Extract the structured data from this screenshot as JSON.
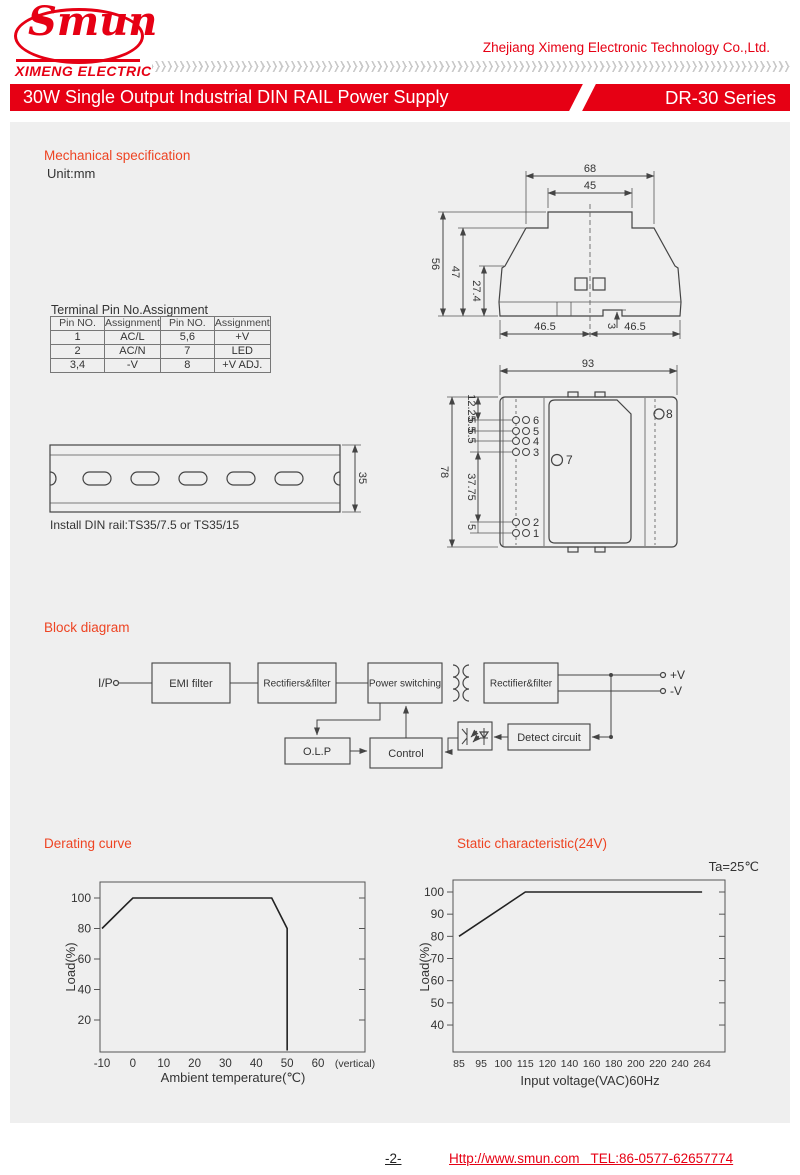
{
  "colors": {
    "brand_red": "#e60014",
    "accent": "#ee4423",
    "panel_bg": "#efefef"
  },
  "header": {
    "logo_name": "Smun",
    "logo_subtitle": "XIMENG ELECTRIC",
    "company": "Zhejiang Ximeng Electronic Technology Co.,Ltd.",
    "banner_title": "30W Single Output Industrial DIN RAIL Power Supply",
    "banner_series": "DR-30 Series"
  },
  "mechanical": {
    "title": "Mechanical specification",
    "unit": "Unit:mm",
    "pin_table": {
      "title": "Terminal Pin No.Assignment",
      "headers": [
        "Pin NO.",
        "Assignment",
        "Pin NO.",
        "Assignment"
      ],
      "rows": [
        [
          "1",
          "AC/L",
          "5,6",
          "+V"
        ],
        [
          "2",
          "AC/N",
          "7",
          "LED"
        ],
        [
          "3,4",
          "-V",
          "8",
          "+V ADJ."
        ]
      ]
    },
    "side_view": {
      "w68": "68",
      "w45": "45",
      "h56": "56",
      "h47": "47",
      "h27": "27.4",
      "b465l": "46.5",
      "b465r": "46.5",
      "n3": "3"
    },
    "front_view": {
      "w93": "93",
      "h78": "78",
      "d1225": "12.25",
      "d55a": "5.5",
      "d55b": "5.5",
      "d3775": "37.75",
      "d5": "5",
      "pin6": "6",
      "pin5": "5",
      "pin4": "4",
      "pin3": "3",
      "pin2": "2",
      "pin1": "1",
      "pin7": "7",
      "pin8": "8"
    },
    "din_rail": {
      "h35": "35",
      "caption": "Install DIN rail:TS35/7.5 or TS35/15"
    }
  },
  "block": {
    "title": "Block diagram",
    "input": "I/P",
    "emi": "EMI filter",
    "rect1": "Rectifiers&filter",
    "power": "Power switching",
    "rect2": "Rectifier&filter",
    "olp": "O.L.P",
    "control": "Control",
    "detect": "Detect circuit",
    "out_pos": "+V",
    "out_neg": "-V"
  },
  "chart_data": [
    {
      "type": "line",
      "title": "Derating curve",
      "xlabel": "Ambient temperature(℃)",
      "ylabel": "Load(%)",
      "xticks": [
        "-10",
        "0",
        "10",
        "20",
        "30",
        "40",
        "50",
        "60"
      ],
      "xtick_suffix": "(vertical)",
      "yticks": [
        "20",
        "40",
        "60",
        "80",
        "100"
      ],
      "points": [
        [
          -10,
          80
        ],
        [
          0,
          100
        ],
        [
          45,
          100
        ],
        [
          50,
          80
        ],
        [
          50,
          0
        ]
      ],
      "xlim": [
        -11,
        70
      ],
      "ylim": [
        0,
        112
      ],
      "grid": false,
      "legend": "none"
    },
    {
      "type": "line",
      "title": "Static characteristic(24V)",
      "annotation": "Ta=25℃",
      "xlabel": "Input voltage(VAC)60Hz",
      "ylabel": "Load(%)",
      "xticks": [
        "85",
        "95",
        "100",
        "115",
        "120",
        "140",
        "160",
        "180",
        "200",
        "220",
        "240",
        "264"
      ],
      "yticks": [
        "40",
        "50",
        "60",
        "70",
        "80",
        "90",
        "100"
      ],
      "points": [
        [
          85,
          80
        ],
        [
          115,
          100
        ],
        [
          264,
          100
        ]
      ],
      "ylim": [
        33,
        112
      ],
      "grid": false,
      "legend": "none"
    }
  ],
  "footer": {
    "page": "-2-",
    "link": "Http://www.smun.com   TEL:86-0577-62657774"
  }
}
